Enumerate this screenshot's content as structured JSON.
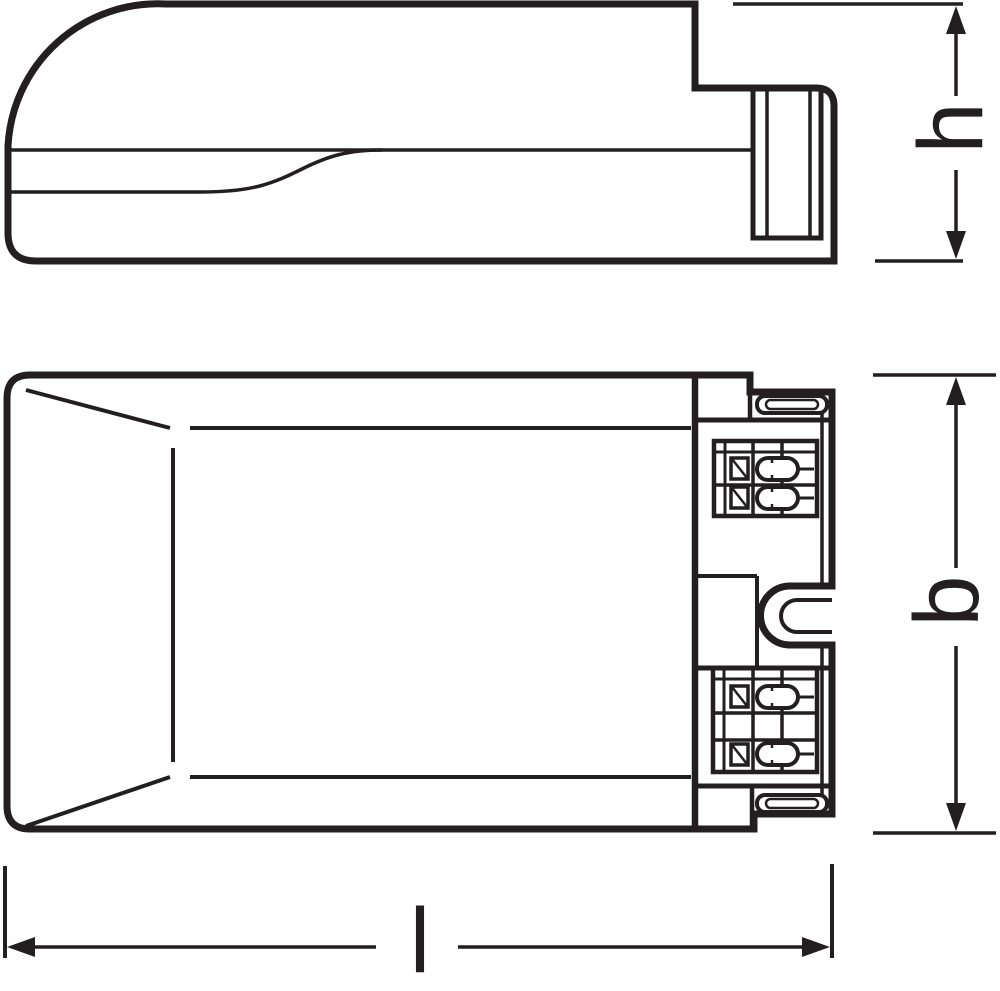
{
  "dimensions": {
    "height": {
      "label": "h",
      "orientation": "vertical",
      "applies_to": "side view"
    },
    "depth": {
      "label": "b",
      "orientation": "vertical",
      "applies_to": "top view"
    },
    "length": {
      "label": "l",
      "orientation": "horizontal",
      "applies_to": "top view"
    }
  },
  "colors": {
    "line": "#231f20",
    "background": "#ffffff"
  }
}
